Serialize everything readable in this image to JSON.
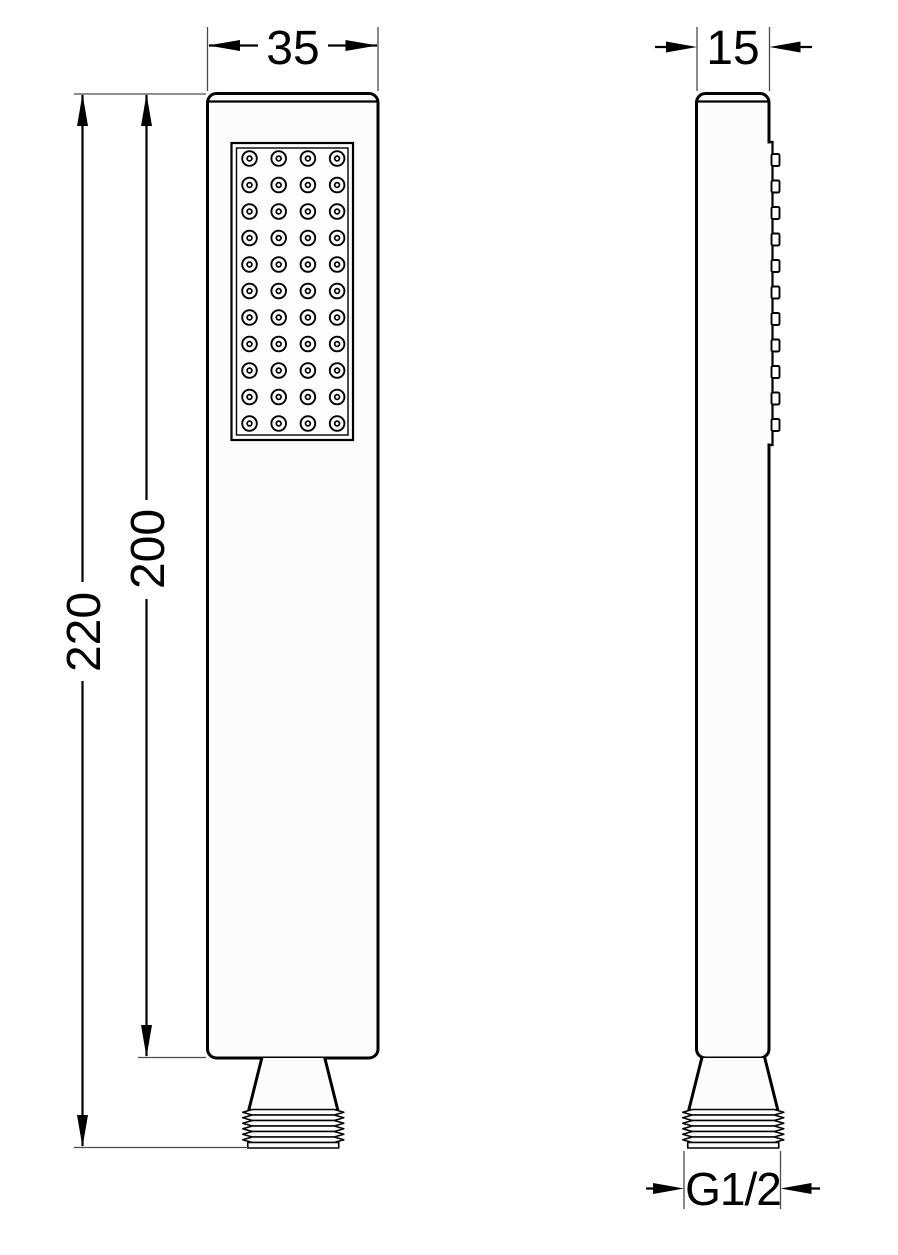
{
  "drawing": {
    "subject": "hand-shower-two-view-technical-drawing",
    "background": "#ffffff",
    "colors": {
      "line": "#000000",
      "thin_line": "#4a4a4a",
      "fill": "#fcfcfc"
    },
    "nozzle_grid": {
      "columns": 4,
      "rows": 11
    },
    "thread_ridges": 7
  },
  "dimensions": {
    "front_width": "35",
    "side_width": "15",
    "overall_height": "220",
    "body_height": "200",
    "thread_size": "G1/2"
  }
}
